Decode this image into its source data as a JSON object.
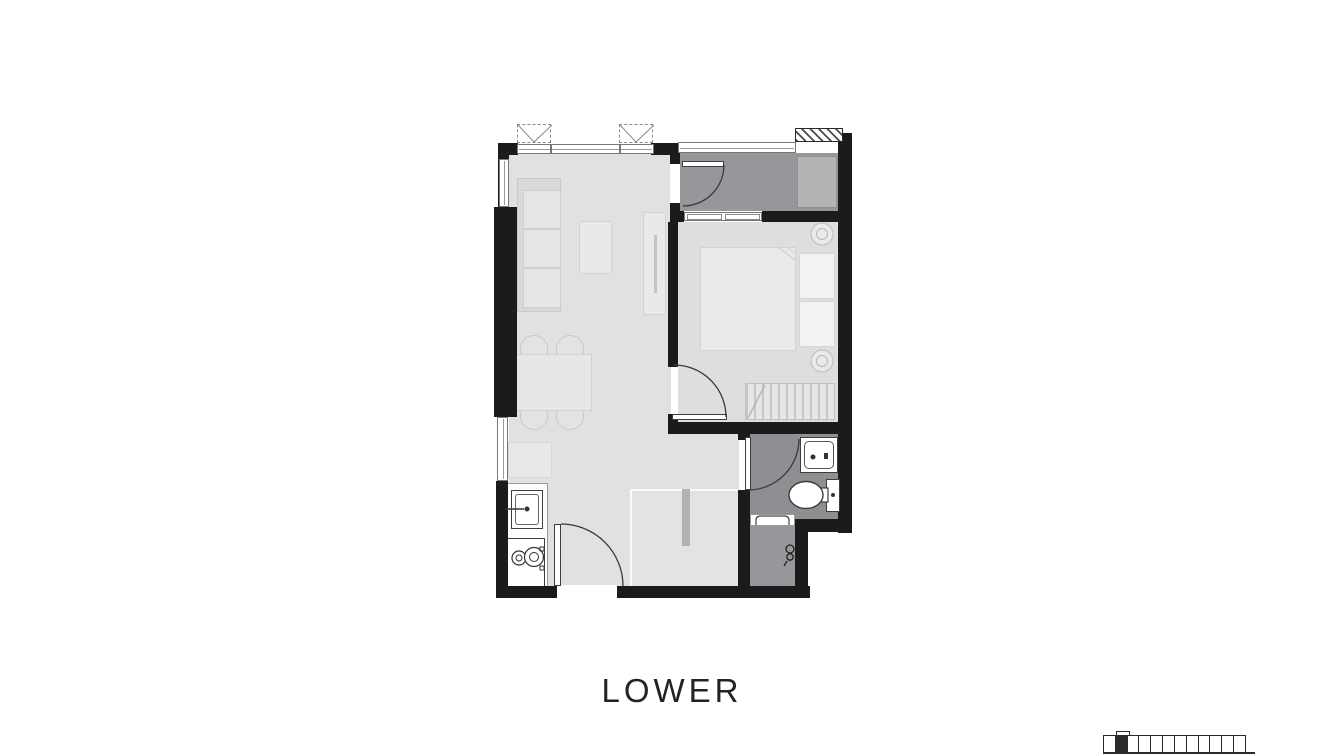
{
  "title": {
    "label": "LOWER"
  },
  "colors": {
    "wall": "#1b1b1b",
    "floor_light": "#e1e1e2",
    "floor_bedroom": "#dedee0",
    "zone_dark": "#97979b",
    "zone_bath": "#8e8e93",
    "fixture_stroke": "#3d3d3d",
    "key_plan_highlight": "#2a2a2a"
  },
  "key_plan": {
    "units_total": 12,
    "highlighted_unit_index": 1
  }
}
